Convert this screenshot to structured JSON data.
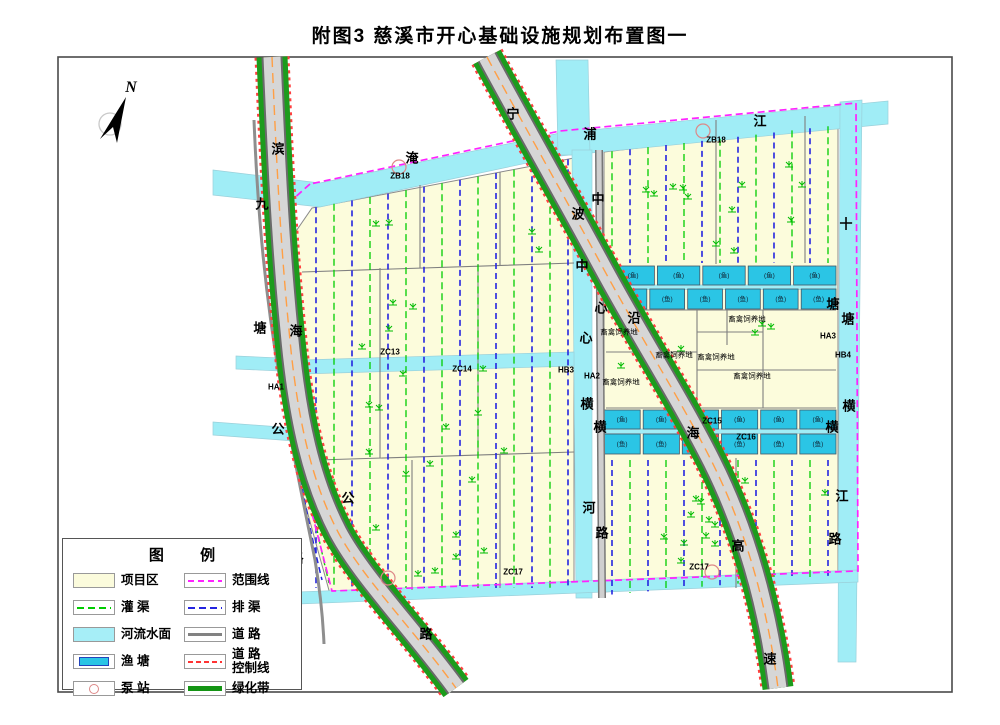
{
  "title": "附图3  慈溪市开心基础设施规划布置图一",
  "north": {
    "label": "N"
  },
  "legend": {
    "title": "图 例",
    "items": [
      {
        "label": "项目区",
        "type": "area-project"
      },
      {
        "label": "范围线",
        "type": "line-boundary"
      },
      {
        "label": "灌  渠",
        "type": "line-irrigation"
      },
      {
        "label": "排  渠",
        "type": "line-drainage"
      },
      {
        "label": "河流水面",
        "type": "area-river"
      },
      {
        "label": "道  路",
        "type": "line-road"
      },
      {
        "label": "渔  塘",
        "type": "area-pond"
      },
      {
        "label": "道 路\n控制线",
        "type": "line-road-control"
      },
      {
        "label": "泵  站",
        "type": "symbol-pump"
      },
      {
        "label": "绿化带",
        "type": "line-greenbelt"
      }
    ]
  },
  "map": {
    "pond_label": "(鱼)",
    "river_name_chars": [
      {
        "t": "淹",
        "x": 412,
        "y": 157
      },
      {
        "t": "浦",
        "x": 590,
        "y": 133
      },
      {
        "t": "江",
        "x": 760,
        "y": 120
      },
      {
        "t": "中",
        "x": 582,
        "y": 265
      },
      {
        "t": "心",
        "x": 586,
        "y": 337
      },
      {
        "t": "横",
        "x": 587,
        "y": 403
      },
      {
        "t": "河",
        "x": 589,
        "y": 507
      },
      {
        "t": "十",
        "x": 846,
        "y": 223
      },
      {
        "t": "塘",
        "x": 848,
        "y": 318
      },
      {
        "t": "横",
        "x": 849,
        "y": 405
      },
      {
        "t": "江",
        "x": 842,
        "y": 495
      }
    ],
    "road_name_chars": [
      {
        "t": "滨",
        "x": 278,
        "y": 148
      },
      {
        "t": "海",
        "x": 296,
        "y": 330
      },
      {
        "t": "公",
        "x": 348,
        "y": 497
      },
      {
        "t": "路",
        "x": 426,
        "y": 633
      },
      {
        "t": "九",
        "x": 262,
        "y": 203
      },
      {
        "t": "塘",
        "x": 260,
        "y": 327
      },
      {
        "t": "公",
        "x": 278,
        "y": 428
      },
      {
        "t": "路",
        "x": 297,
        "y": 557
      },
      {
        "t": "宁",
        "x": 513,
        "y": 113
      },
      {
        "t": "波",
        "x": 578,
        "y": 213
      },
      {
        "t": "沿",
        "x": 634,
        "y": 317
      },
      {
        "t": "海",
        "x": 693,
        "y": 432
      },
      {
        "t": "高",
        "x": 738,
        "y": 545
      },
      {
        "t": "速",
        "x": 770,
        "y": 658
      },
      {
        "t": "中",
        "x": 598,
        "y": 198
      },
      {
        "t": "心",
        "x": 601,
        "y": 307
      },
      {
        "t": "横",
        "x": 600,
        "y": 426
      },
      {
        "t": "路",
        "x": 602,
        "y": 532
      },
      {
        "t": "塘",
        "x": 833,
        "y": 303
      },
      {
        "t": "横",
        "x": 832,
        "y": 426
      },
      {
        "t": "路",
        "x": 835,
        "y": 538
      }
    ],
    "zone_labels": [
      {
        "t": "ZB18",
        "x": 400,
        "y": 176
      },
      {
        "t": "ZB18",
        "x": 716,
        "y": 140
      },
      {
        "t": "ZC13",
        "x": 390,
        "y": 352
      },
      {
        "t": "ZC14",
        "x": 462,
        "y": 369
      },
      {
        "t": "ZC15",
        "x": 712,
        "y": 421
      },
      {
        "t": "ZC16",
        "x": 746,
        "y": 437
      },
      {
        "t": "ZC17",
        "x": 513,
        "y": 572
      },
      {
        "t": "ZC17",
        "x": 699,
        "y": 567
      },
      {
        "t": "HA1",
        "x": 276,
        "y": 387
      },
      {
        "t": "HB3",
        "x": 566,
        "y": 370
      },
      {
        "t": "HA2",
        "x": 592,
        "y": 376
      },
      {
        "t": "HA3",
        "x": 828,
        "y": 336
      },
      {
        "t": "HB4",
        "x": 843,
        "y": 355
      }
    ],
    "facility_labels": [
      {
        "t": "畜禽饲养地",
        "x": 619,
        "y": 332
      },
      {
        "t": "畜禽饲养地",
        "x": 747,
        "y": 319
      },
      {
        "t": "畜禽饲养地",
        "x": 674,
        "y": 355
      },
      {
        "t": "畜禽饲养地",
        "x": 716,
        "y": 357
      },
      {
        "t": "畜禽饲养地",
        "x": 752,
        "y": 376
      },
      {
        "t": "畜禽饲养地",
        "x": 621,
        "y": 382
      }
    ]
  },
  "colors": {
    "project_area": "#FCFCDC",
    "river": "#A0EDF6",
    "pond": "#2BC5E5",
    "greenbelt": "#1C9C1C",
    "boundary": "#FF22FF",
    "irrigation": "#00CC00",
    "drainage": "#2424E0",
    "road_gray": "#828282",
    "road_control": "#FF3333"
  }
}
